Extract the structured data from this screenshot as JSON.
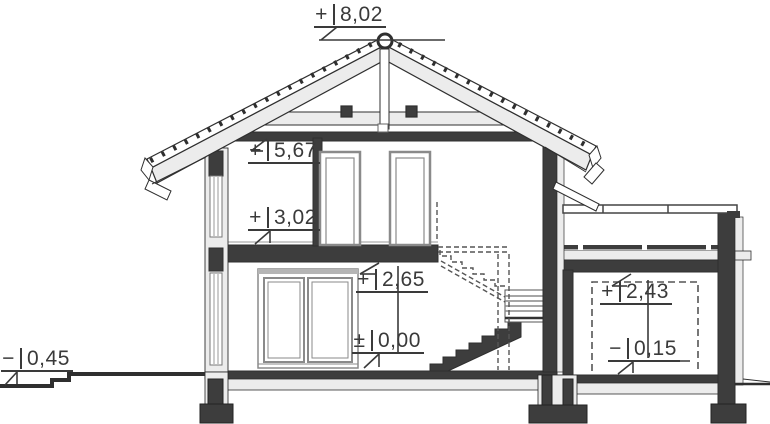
{
  "drawing": {
    "kind": "house-cross-section",
    "colors": {
      "cut_wall": "#3d3d3d",
      "light_layer": "#ececec",
      "outline": "#2f2f2f",
      "frame_gray": "#8a8a8a",
      "hidden_dashed": "#555555",
      "annotation_text": "#3a3a3a",
      "background": "#ffffff"
    }
  },
  "levels": [
    {
      "id": "ridge",
      "sign": "+",
      "value": "8,02"
    },
    {
      "id": "upper-ceiling",
      "sign": "+",
      "value": "5,67"
    },
    {
      "id": "upper-floor",
      "sign": "+",
      "value": "3,02"
    },
    {
      "id": "ground-ceiling",
      "sign": "+",
      "value": "2,65"
    },
    {
      "id": "ground-floor",
      "sign": "±",
      "value": "0,00"
    },
    {
      "id": "annex-ceiling",
      "sign": "+",
      "value": "2,43"
    },
    {
      "id": "garage-floor",
      "sign": "−",
      "value": "0,15"
    },
    {
      "id": "grade",
      "sign": "−",
      "value": "0,45"
    }
  ]
}
